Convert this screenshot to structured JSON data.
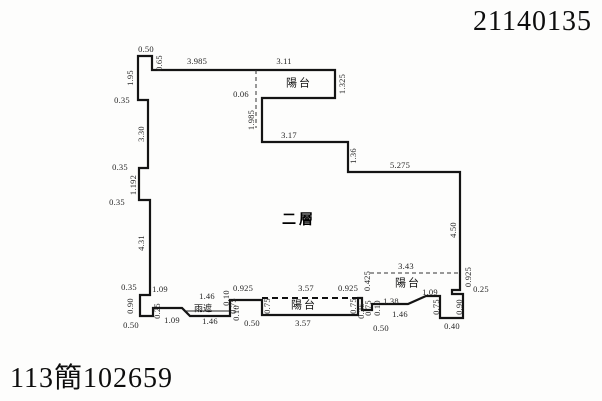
{
  "header": {
    "document_number": "21140135"
  },
  "footer": {
    "case_number": "113簡102659"
  },
  "plan": {
    "floor_label": {
      "t": "二層",
      "x": 299,
      "y": 219
    },
    "area_labels": [
      {
        "t": "陽台",
        "x": 299,
        "y": 84,
        "small": false
      },
      {
        "t": "陽台",
        "x": 304,
        "y": 306,
        "small": false
      },
      {
        "t": "陽台",
        "x": 408,
        "y": 284,
        "small": false
      },
      {
        "t": "雨遮",
        "x": 203,
        "y": 309,
        "small": true
      }
    ],
    "dimensions": [
      {
        "t": "0.50",
        "x": 146,
        "y": 49,
        "r": 0
      },
      {
        "t": "1.95",
        "x": 130,
        "y": 78,
        "r": -90
      },
      {
        "t": "0.65",
        "x": 159,
        "y": 63,
        "r": -90
      },
      {
        "t": "3.985",
        "x": 197,
        "y": 61,
        "r": 0
      },
      {
        "t": "3.11",
        "x": 284,
        "y": 61,
        "r": 0
      },
      {
        "t": "1.325",
        "x": 342,
        "y": 84,
        "r": -90
      },
      {
        "t": "0.06",
        "x": 241,
        "y": 94,
        "r": 0
      },
      {
        "t": "0.35",
        "x": 122,
        "y": 100,
        "r": 0
      },
      {
        "t": "3.30",
        "x": 141,
        "y": 134,
        "r": -90
      },
      {
        "t": "1.985",
        "x": 251,
        "y": 120,
        "r": -90
      },
      {
        "t": "3.17",
        "x": 289,
        "y": 135,
        "r": 0
      },
      {
        "t": "1.36",
        "x": 353,
        "y": 156,
        "r": -90
      },
      {
        "t": "5.275",
        "x": 400,
        "y": 165,
        "r": 0
      },
      {
        "t": "0.35",
        "x": 120,
        "y": 167,
        "r": 0
      },
      {
        "t": "1.192",
        "x": 133,
        "y": 185,
        "r": -90
      },
      {
        "t": "0.35",
        "x": 117,
        "y": 202,
        "r": 0
      },
      {
        "t": "4.31",
        "x": 141,
        "y": 243,
        "r": -90
      },
      {
        "t": "4.50",
        "x": 453,
        "y": 230,
        "r": -90
      },
      {
        "t": "0.35",
        "x": 129,
        "y": 287,
        "r": 0
      },
      {
        "t": "1.09",
        "x": 160,
        "y": 289,
        "r": 0
      },
      {
        "t": "0.90",
        "x": 130,
        "y": 306,
        "r": -90
      },
      {
        "t": "0.50",
        "x": 131,
        "y": 325,
        "r": 0
      },
      {
        "t": "0.25",
        "x": 157,
        "y": 311,
        "r": -90
      },
      {
        "t": "1.09",
        "x": 172,
        "y": 320,
        "r": 0
      },
      {
        "t": "1.46",
        "x": 207,
        "y": 296,
        "r": 0
      },
      {
        "t": "0.10",
        "x": 226,
        "y": 298,
        "r": -90
      },
      {
        "t": "1.46",
        "x": 210,
        "y": 321,
        "r": 0
      },
      {
        "t": "0.10",
        "x": 236,
        "y": 313,
        "r": -90
      },
      {
        "t": "0.75",
        "x": 233,
        "y": 306,
        "r": -90
      },
      {
        "t": "0.925",
        "x": 243,
        "y": 288,
        "r": 0
      },
      {
        "t": "0.50",
        "x": 252,
        "y": 323,
        "r": 0
      },
      {
        "t": "0.75",
        "x": 267,
        "y": 306,
        "r": -90
      },
      {
        "t": "3.57",
        "x": 306,
        "y": 288,
        "r": 0
      },
      {
        "t": "3.57",
        "x": 303,
        "y": 323,
        "r": 0
      },
      {
        "t": "0.925",
        "x": 348,
        "y": 288,
        "r": 0
      },
      {
        "t": "0.75",
        "x": 353,
        "y": 306,
        "r": -90
      },
      {
        "t": "0.25",
        "x": 361,
        "y": 311,
        "r": -90
      },
      {
        "t": "0.425",
        "x": 367,
        "y": 281,
        "r": -90
      },
      {
        "t": "0.75",
        "x": 368,
        "y": 308,
        "r": -90
      },
      {
        "t": "0.50",
        "x": 381,
        "y": 328,
        "r": 0
      },
      {
        "t": "3.43",
        "x": 406,
        "y": 266,
        "r": 0
      },
      {
        "t": "1.38",
        "x": 391,
        "y": 301,
        "r": 0
      },
      {
        "t": "0.10",
        "x": 377,
        "y": 308,
        "r": -90
      },
      {
        "t": "1.46",
        "x": 400,
        "y": 314,
        "r": 0
      },
      {
        "t": "1.09",
        "x": 430,
        "y": 292,
        "r": 0
      },
      {
        "t": "0.75",
        "x": 436,
        "y": 307,
        "r": -90
      },
      {
        "t": "0.90",
        "x": 459,
        "y": 307,
        "r": -90
      },
      {
        "t": "0.40",
        "x": 452,
        "y": 326,
        "r": 0
      },
      {
        "t": "0.925",
        "x": 468,
        "y": 277,
        "r": -90
      },
      {
        "t": "0.25",
        "x": 481,
        "y": 289,
        "r": 0
      }
    ]
  }
}
